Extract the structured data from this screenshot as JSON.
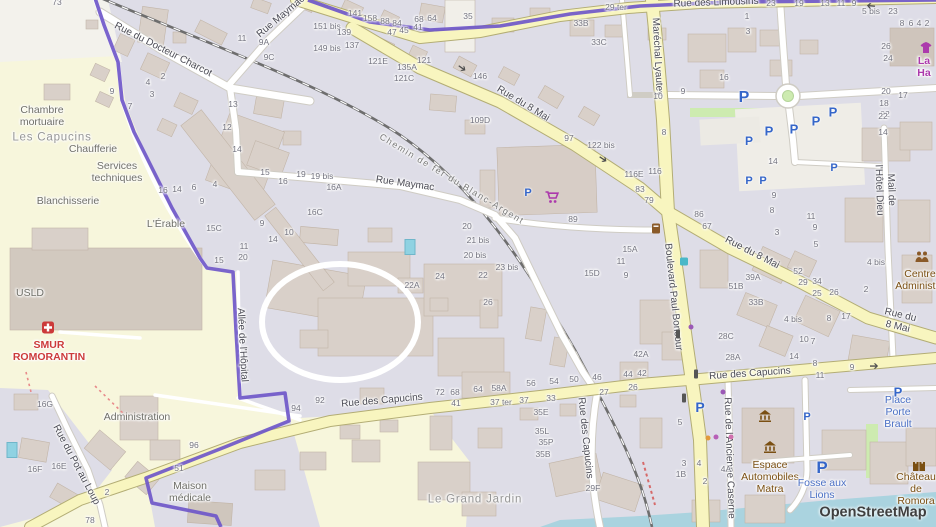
{
  "attribution": "OpenStreetMap",
  "colors": {
    "boundary_purple": "#6f57c9",
    "road_yellow": "#f8f5bf",
    "water_blue": "#aad3df",
    "hospital_area_yellow": "#f7f6dc",
    "residential_gray": "#dedde7",
    "building_gray": "#d9d0c9",
    "parking_blue": "#3566c9",
    "shop_magenta": "#ac39ac",
    "poi_brown": "#7a4f12",
    "emergency_red": "#cc3a3a"
  },
  "street_labels": [
    {
      "text": "Rue du Docteur Charcot",
      "x": 163,
      "y": 50,
      "rot": 27,
      "kind": "st"
    },
    {
      "text": "Rue Maymac",
      "x": 281,
      "y": 17,
      "rot": -40,
      "kind": "st"
    },
    {
      "text": "Rue Maymac",
      "x": 405,
      "y": 184,
      "rot": 8,
      "kind": "st"
    },
    {
      "text": "Rue du 8 Mai",
      "x": 523,
      "y": 104,
      "rot": 31,
      "kind": "st"
    },
    {
      "text": "Rue du 8 Mai",
      "x": 752,
      "y": 253,
      "rot": 27,
      "kind": "st"
    },
    {
      "text": "Rue du 8 Mai",
      "x": 899,
      "y": 321,
      "rot": 13,
      "kind": "st"
    },
    {
      "text": "Rue des Limousins",
      "x": 716,
      "y": 3,
      "rot": -2,
      "kind": "st"
    },
    {
      "text": "Maréchal Lyautey",
      "x": 657,
      "y": 57,
      "rot": 87,
      "kind": "st"
    },
    {
      "text": "Boulevard Paul Boncour",
      "x": 673,
      "y": 297,
      "rot": 84,
      "kind": "st"
    },
    {
      "text": "Rue des Capucins",
      "x": 382,
      "y": 401,
      "rot": -5,
      "kind": "st"
    },
    {
      "text": "Rue des Capucins",
      "x": 750,
      "y": 374,
      "rot": -4,
      "kind": "st"
    },
    {
      "text": "Rue des Capucins",
      "x": 585,
      "y": 438,
      "rot": 84,
      "kind": "st"
    },
    {
      "text": "Rue du Pot au Loup",
      "x": 76,
      "y": 465,
      "rot": 62,
      "kind": "st"
    },
    {
      "text": "Allée de l'Hôpital",
      "x": 242,
      "y": 345,
      "rot": 87,
      "kind": "st"
    },
    {
      "text": "Mail de l'Hôtel Dieu",
      "x": 885,
      "y": 190,
      "rot": 88,
      "kind": "st"
    },
    {
      "text": "Rue de l'Ancienne Caserne",
      "x": 729,
      "y": 458,
      "rot": 88,
      "kind": "st"
    },
    {
      "text": "Chemin de fer du Blanc-Argent",
      "x": 452,
      "y": 179,
      "rot": 31,
      "kind": "rw"
    }
  ],
  "place_labels": [
    {
      "text": "Chambre\nmortuaire",
      "x": 42,
      "y": 116,
      "kind": "area"
    },
    {
      "text": "Les Capucins",
      "x": 52,
      "y": 138,
      "kind": "quarter"
    },
    {
      "text": "Chaufferie",
      "x": 93,
      "y": 149,
      "kind": "area"
    },
    {
      "text": "Services\ntechniques",
      "x": 117,
      "y": 172,
      "kind": "area"
    },
    {
      "text": "Blanchisserie",
      "x": 68,
      "y": 201,
      "kind": "area"
    },
    {
      "text": "L'Érable",
      "x": 166,
      "y": 224,
      "kind": "area"
    },
    {
      "text": "USLD",
      "x": 30,
      "y": 293,
      "kind": "area"
    },
    {
      "text": "SMUR\nROMORANTIN",
      "x": 49,
      "y": 351,
      "kind": "red"
    },
    {
      "text": "Administration",
      "x": 137,
      "y": 417,
      "kind": "area"
    },
    {
      "text": "Maison\nmédicale",
      "x": 190,
      "y": 492,
      "kind": "area"
    },
    {
      "text": "Le Grand Jardin",
      "x": 475,
      "y": 500,
      "kind": "quarter"
    },
    {
      "text": "Espace\nAutomobiles\nMatra",
      "x": 770,
      "y": 477,
      "kind": "brown"
    },
    {
      "text": "Fosse aux\nLions",
      "x": 822,
      "y": 489,
      "kind": "blue"
    },
    {
      "text": "Place Porte\nBrault",
      "x": 898,
      "y": 412,
      "kind": "blue"
    },
    {
      "text": "Château\nde Romora",
      "x": 916,
      "y": 489,
      "kind": "brown"
    },
    {
      "text": "Centre\nAdministra",
      "x": 920,
      "y": 280,
      "kind": "brown"
    },
    {
      "text": "La Ha",
      "x": 924,
      "y": 67,
      "kind": "mag"
    }
  ],
  "house_numbers": [
    [
      "73",
      57,
      3
    ],
    [
      "11",
      242,
      39
    ],
    [
      "9A",
      264,
      43
    ],
    [
      "9C",
      269,
      58
    ],
    [
      "2",
      163,
      77
    ],
    [
      "4",
      148,
      83
    ],
    [
      "3",
      152,
      95
    ],
    [
      "7",
      130,
      107
    ],
    [
      "9",
      112,
      92
    ],
    [
      "13",
      233,
      105
    ],
    [
      "12",
      227,
      128
    ],
    [
      "14",
      237,
      150
    ],
    [
      "16",
      163,
      191
    ],
    [
      "14",
      177,
      190
    ],
    [
      "6",
      194,
      188
    ],
    [
      "4",
      215,
      185
    ],
    [
      "9",
      202,
      202
    ],
    [
      "15C",
      214,
      229
    ],
    [
      "15",
      219,
      261
    ],
    [
      "151 bis",
      327,
      27
    ],
    [
      "149 bis",
      327,
      49
    ],
    [
      "141",
      355,
      14
    ],
    [
      "158",
      370,
      19
    ],
    [
      "88",
      385,
      22
    ],
    [
      "84",
      397,
      24
    ],
    [
      "68",
      419,
      20
    ],
    [
      "64",
      432,
      19
    ],
    [
      "35",
      468,
      17
    ],
    [
      "47",
      392,
      33
    ],
    [
      "45",
      404,
      31
    ],
    [
      "41",
      418,
      28
    ],
    [
      "139",
      344,
      33
    ],
    [
      "137",
      352,
      46
    ],
    [
      "121E",
      378,
      62
    ],
    [
      "135A",
      407,
      68
    ],
    [
      "121C",
      404,
      79
    ],
    [
      "121",
      424,
      61
    ],
    [
      "146",
      480,
      77
    ],
    [
      "109D",
      480,
      121
    ],
    [
      "97",
      569,
      139
    ],
    [
      "122 bis",
      601,
      146
    ],
    [
      "29 ter",
      616,
      8
    ],
    [
      "33B",
      581,
      24
    ],
    [
      "33C",
      599,
      43
    ],
    [
      "23",
      771,
      4
    ],
    [
      "19",
      799,
      4
    ],
    [
      "13",
      825,
      4
    ],
    [
      "11",
      841,
      4
    ],
    [
      "9",
      854,
      4
    ],
    [
      "5 bis",
      871,
      12
    ],
    [
      "23",
      893,
      12
    ],
    [
      "8",
      902,
      24
    ],
    [
      "6",
      911,
      24
    ],
    [
      "4",
      919,
      24
    ],
    [
      "2",
      927,
      24
    ],
    [
      "26",
      886,
      47
    ],
    [
      "24",
      888,
      59
    ],
    [
      "20",
      886,
      92
    ],
    [
      "18",
      884,
      104
    ],
    [
      "22",
      885,
      115
    ],
    [
      "17",
      903,
      96
    ],
    [
      "16",
      724,
      78
    ],
    [
      "9",
      683,
      92
    ],
    [
      "10",
      658,
      97
    ],
    [
      "8",
      664,
      133
    ],
    [
      "1",
      747,
      17
    ],
    [
      "3",
      748,
      32
    ],
    [
      "22",
      883,
      117
    ],
    [
      "14",
      883,
      133
    ],
    [
      "116E",
      634,
      175
    ],
    [
      "116",
      655,
      172
    ],
    [
      "83",
      640,
      190
    ],
    [
      "79",
      649,
      201
    ],
    [
      "86",
      699,
      215
    ],
    [
      "67",
      707,
      227
    ],
    [
      "14",
      773,
      162
    ],
    [
      "9",
      774,
      196
    ],
    [
      "8",
      772,
      211
    ],
    [
      "11",
      811,
      217
    ],
    [
      "9",
      815,
      228
    ],
    [
      "3",
      777,
      233
    ],
    [
      "5",
      816,
      245
    ],
    [
      "4 bis",
      876,
      263
    ],
    [
      "2",
      866,
      290
    ],
    [
      "52",
      798,
      272
    ],
    [
      "29",
      803,
      283
    ],
    [
      "34",
      817,
      282
    ],
    [
      "25",
      817,
      294
    ],
    [
      "26",
      834,
      293
    ],
    [
      "17",
      846,
      317
    ],
    [
      "8",
      829,
      319
    ],
    [
      "39A",
      753,
      278
    ],
    [
      "51B",
      736,
      287
    ],
    [
      "33B",
      756,
      303
    ],
    [
      "4 bis",
      793,
      320
    ],
    [
      "28C",
      726,
      337
    ],
    [
      "28A",
      733,
      358
    ],
    [
      "10",
      804,
      340
    ],
    [
      "7",
      813,
      342
    ],
    [
      "14",
      794,
      357
    ],
    [
      "11",
      820,
      376
    ],
    [
      "9",
      852,
      368
    ],
    [
      "8",
      815,
      364
    ],
    [
      "89",
      573,
      220
    ],
    [
      "15A",
      630,
      250
    ],
    [
      "15D",
      592,
      274
    ],
    [
      "11",
      621,
      262
    ],
    [
      "9",
      626,
      276
    ],
    [
      "42A",
      641,
      355
    ],
    [
      "44",
      628,
      375
    ],
    [
      "42",
      642,
      374
    ],
    [
      "15",
      265,
      173
    ],
    [
      "16",
      283,
      182
    ],
    [
      "19",
      301,
      175
    ],
    [
      "19 bis",
      322,
      177
    ],
    [
      "16A",
      334,
      188
    ],
    [
      "16C",
      315,
      213
    ],
    [
      "9",
      262,
      224
    ],
    [
      "14",
      273,
      240
    ],
    [
      "10",
      289,
      233
    ],
    [
      "11",
      244,
      247
    ],
    [
      "20",
      243,
      258
    ],
    [
      "20",
      467,
      227
    ],
    [
      "21 bis",
      478,
      241
    ],
    [
      "20 bis",
      475,
      256
    ],
    [
      "23 bis",
      507,
      268
    ],
    [
      "22",
      483,
      276
    ],
    [
      "24",
      440,
      277
    ],
    [
      "22A",
      412,
      286
    ],
    [
      "26",
      488,
      303
    ],
    [
      "94",
      296,
      409
    ],
    [
      "92",
      320,
      401
    ],
    [
      "72",
      440,
      393
    ],
    [
      "68",
      455,
      393
    ],
    [
      "64",
      478,
      390
    ],
    [
      "58A",
      499,
      389
    ],
    [
      "56",
      531,
      384
    ],
    [
      "54",
      554,
      382
    ],
    [
      "50",
      574,
      380
    ],
    [
      "46",
      597,
      378
    ],
    [
      "27",
      604,
      393
    ],
    [
      "41",
      456,
      404
    ],
    [
      "37 ter",
      501,
      403
    ],
    [
      "37",
      524,
      401
    ],
    [
      "33",
      551,
      399
    ],
    [
      "35E",
      541,
      413
    ],
    [
      "35L",
      542,
      432
    ],
    [
      "35P",
      546,
      443
    ],
    [
      "35B",
      543,
      455
    ],
    [
      "29F",
      593,
      489
    ],
    [
      "16G",
      45,
      405
    ],
    [
      "16F",
      35,
      470
    ],
    [
      "16E",
      59,
      467
    ],
    [
      "96",
      194,
      446
    ],
    [
      "51",
      179,
      469
    ],
    [
      "2",
      107,
      493
    ],
    [
      "78",
      90,
      521
    ],
    [
      "26",
      633,
      388
    ],
    [
      "5",
      680,
      423
    ],
    [
      "3",
      684,
      464
    ],
    [
      "4",
      699,
      464
    ],
    [
      "4A",
      726,
      470
    ],
    [
      "1B",
      681,
      475
    ],
    [
      "2",
      705,
      482
    ]
  ],
  "icons": {
    "parking": [
      [
        744,
        98,
        16
      ],
      [
        769,
        131,
        13
      ],
      [
        794,
        129,
        13
      ],
      [
        816,
        121,
        13
      ],
      [
        833,
        112,
        13
      ],
      [
        834,
        168,
        11
      ],
      [
        749,
        141,
        12
      ],
      [
        749,
        181,
        11
      ],
      [
        763,
        181,
        11
      ],
      [
        528,
        193,
        11
      ],
      [
        700,
        407,
        14
      ],
      [
        822,
        468,
        17
      ],
      [
        898,
        392,
        13
      ],
      [
        807,
        417,
        11
      ]
    ],
    "one_way_arrows": [
      [
        462,
        68,
        35
      ],
      [
        603,
        159,
        33
      ],
      [
        871,
        6,
        185
      ],
      [
        874,
        366,
        0
      ]
    ],
    "traffic_lights": [
      [
        678,
        334
      ],
      [
        696,
        374
      ],
      [
        684,
        398
      ]
    ],
    "pois": [
      {
        "type": "supermarket-icon",
        "x": 552,
        "y": 200
      },
      {
        "type": "museum-icon",
        "x": 765,
        "y": 418
      },
      {
        "type": "museum-icon",
        "x": 770,
        "y": 449
      },
      {
        "type": "castle-icon",
        "x": 919,
        "y": 467
      },
      {
        "type": "emergency-icon",
        "x": 48,
        "y": 330
      },
      {
        "type": "clothes-shop-icon",
        "x": 926,
        "y": 50
      },
      {
        "type": "community-icon",
        "x": 922,
        "y": 258
      },
      {
        "type": "postbox-icon",
        "x": 656,
        "y": 230
      },
      {
        "type": "recycling-icon",
        "x": 684,
        "y": 262
      }
    ],
    "dots": [
      [
        691,
        327,
        "#9b59b6"
      ],
      [
        723,
        392,
        "#9b59b6"
      ],
      [
        716,
        437,
        "#b75fb7"
      ],
      [
        731,
        437,
        "#d06fae"
      ],
      [
        708,
        438,
        "#e09a3c"
      ]
    ],
    "pools": [
      [
        410,
        247
      ],
      [
        12,
        450
      ]
    ]
  }
}
